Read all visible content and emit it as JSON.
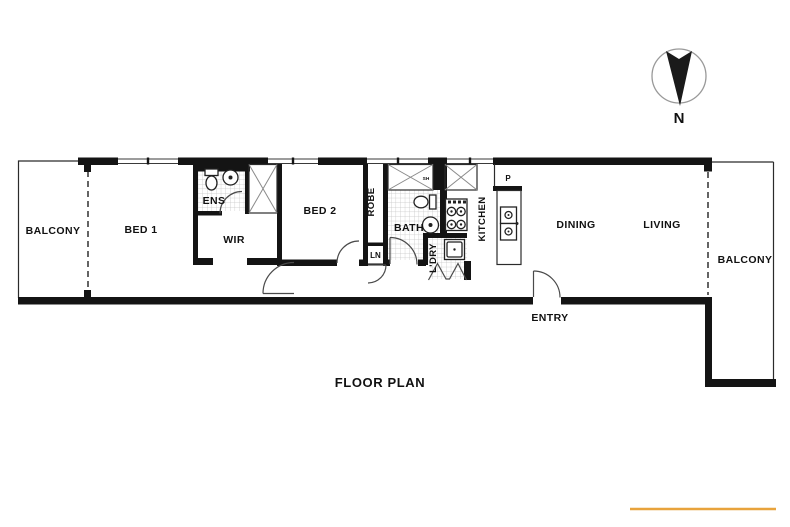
{
  "title": "FLOOR PLAN",
  "compass": {
    "north_label": "N"
  },
  "accent": {
    "underline_color": "#E8A33C"
  },
  "rooms": {
    "balcony_left": "BALCONY",
    "bed1": "BED 1",
    "ens": "ENS",
    "wir": "WIR",
    "bed2": "BED 2",
    "robe": "ROBE",
    "linen": "LN",
    "bath": "BATH",
    "shower": "SH",
    "laundry": "L'DRY",
    "kitchen": "KITCHEN",
    "pantry": "P",
    "dining": "DINING",
    "living": "LIVING",
    "balcony_right": "BALCONY",
    "entry": "ENTRY"
  }
}
